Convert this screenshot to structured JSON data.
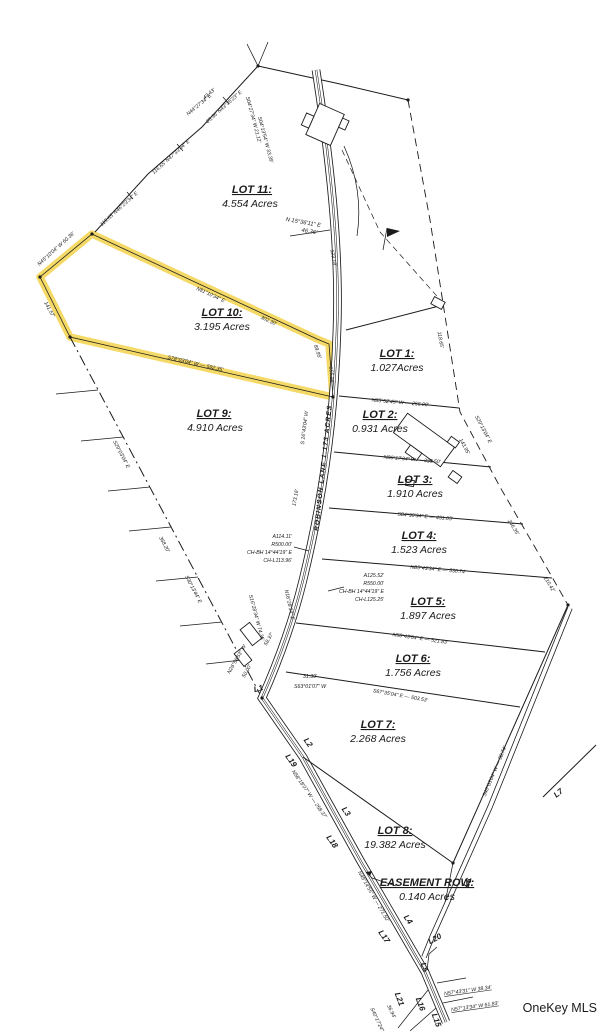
{
  "watermark": "OneKey MLS",
  "map": {
    "road_label": "ROBINSON LANE 1.173 ACRES",
    "lots": {
      "lot11": {
        "title": "LOT 11:",
        "acres": "4.554 Acres"
      },
      "lot10": {
        "title": "LOT 10:",
        "acres": "3.195 Acres"
      },
      "lot9": {
        "title": "LOT 9:",
        "acres": "4.910 Acres"
      },
      "lot1": {
        "title": "LOT 1:",
        "acres": "1.027Acres"
      },
      "lot2": {
        "title": "LOT 2:",
        "acres": "0.931 Acres"
      },
      "lot3": {
        "title": "LOT 3:",
        "acres": "1.910 Acres"
      },
      "lot4": {
        "title": "LOT 4:",
        "acres": "1.523 Acres"
      },
      "lot5": {
        "title": "LOT 5:",
        "acres": "1.897 Acres"
      },
      "lot6": {
        "title": "LOT 6:",
        "acres": "1.756 Acres"
      },
      "lot7": {
        "title": "LOT 7:",
        "acres": "2.268 Acres"
      },
      "lot8": {
        "title": "LOT 8:",
        "acres": "19.382 Acres"
      },
      "easement": {
        "title": "EASEMENT ROW:",
        "acres": "0.140 Acres"
      }
    },
    "curves": {
      "c1": {
        "l1": "A114.11'",
        "l2": "R500.00'",
        "l3": "CH-BH 14°44'19\" E",
        "l4": "CH-L113.96'"
      },
      "c2": {
        "l1": "A125.52'",
        "l2": "R550.00'",
        "l3": "CH-BH 14°44'19\" E",
        "l4": "CH-L125.25'"
      }
    },
    "bearings": {
      "top_bearing": "N 15°36'11\" E",
      "top_dist": "46.36'",
      "nw1": "115.65'   N46°23'34\" E",
      "nw2": "116.65'   N47°33'04\" E",
      "nw3": "85.36'   N43°35'23\" E",
      "y_upleft": "N45°10'04\" W  60.36'",
      "y_top": "N81°10'34\" E",
      "y_right1": "89.95'",
      "y_right2": "156.16'",
      "y_bottom": "S78°03'04\" W — 592.35'",
      "y_left": "141.57'",
      "w1": "S29°03'04\" E",
      "w2": "S30°13'44\" E",
      "e1a": "143.95'",
      "e1b": "S29°13'04\" E",
      "e2": "246.35'",
      "e3": "210.42'",
      "e4": "118.65'",
      "lot12": "N85°52'45\" W — 256.00'",
      "lot23": "N86°17'34\" W — 335.50'",
      "lot34": "S84°30'34\" E — 451.05'",
      "lot45": "N85°43'34\" E — 530.74'",
      "lot56": "N50°43'04\" E — 521.83'",
      "lot67": "S67°35'04\" E — 503.53'",
      "road1": "N58°18'07\" W — 258.37'",
      "road2": "N49°14'55\" W — 271.50'",
      "bottom1": "N57°43'31\" W   38.34'",
      "bottom2": "N57°13'34\" W   61.83'",
      "l6road": "S40°03'04\" W — 98.74'"
    },
    "lines": {
      "l1": "L1",
      "l2": "L2",
      "l3": "L3",
      "l4": "L4",
      "l5": "L5",
      "l6": "L6",
      "l7": "L7",
      "l15": "L15",
      "l16": "L16",
      "l17": "L17",
      "l18": "L18",
      "l19": "L19",
      "l20": "L20",
      "l21": "L21"
    },
    "scribbles": [
      "43.43'",
      "N44°27'34\" E",
      "S04°27'34\" W  21.12'",
      "S04°13'54\" W  33.39'",
      "123.18'",
      "S 16°43'04\" W",
      "173.16'",
      "58.37'",
      "31.39'",
      "S63°01'07\" W",
      "50.00'",
      "N26°58'53\" W",
      "S16°28'34\" W  74.35'",
      "368.20'",
      "N16°28'34\" E",
      "36.94'",
      "S40°17'24\" W",
      "302.30'"
    ],
    "colors": {
      "highlight": "#F2D24B",
      "ink": "#1b1b1b",
      "watermark": "#b9b9b9"
    }
  }
}
